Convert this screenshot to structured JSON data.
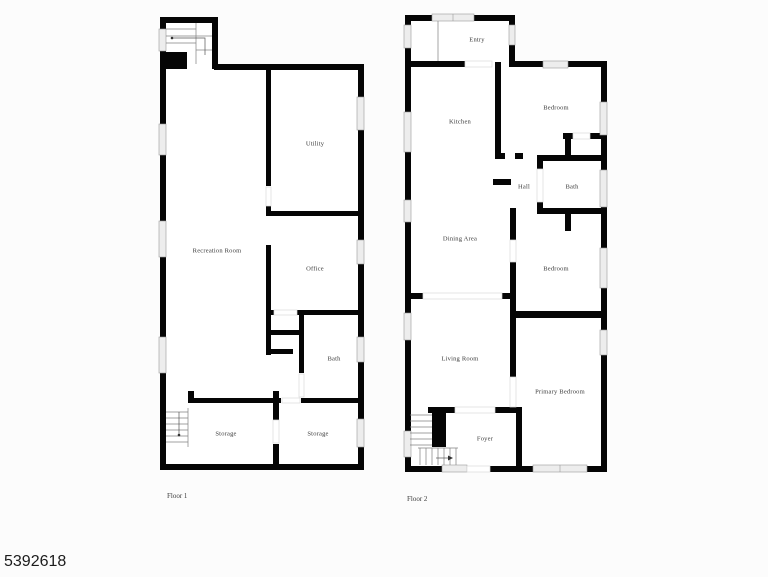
{
  "photo_id": "5392618",
  "floor1": {
    "caption": "Floor 1",
    "rooms": [
      {
        "label": "Recreation Room"
      },
      {
        "label": "Utility"
      },
      {
        "label": "Office"
      },
      {
        "label": "Bath"
      },
      {
        "label": "Storage"
      },
      {
        "label": "Storage"
      }
    ]
  },
  "floor2": {
    "caption": "Floor 2",
    "rooms": [
      {
        "label": "Entry"
      },
      {
        "label": "Kitchen"
      },
      {
        "label": "Bedroom"
      },
      {
        "label": "Hall"
      },
      {
        "label": "Bath"
      },
      {
        "label": "Dining Area"
      },
      {
        "label": "Bedroom"
      },
      {
        "label": "Living Room"
      },
      {
        "label": "Primary Bedroom"
      },
      {
        "label": "Foyer"
      }
    ]
  },
  "colors": {
    "background": "#fcfcfc",
    "wall": "#050505",
    "room_fill": "#ffffff",
    "window_fill": "#ededed",
    "window_outline": "#9a9a9a",
    "label_text": "#3a3a3a",
    "photo_id_text": "#1c1c1c"
  }
}
